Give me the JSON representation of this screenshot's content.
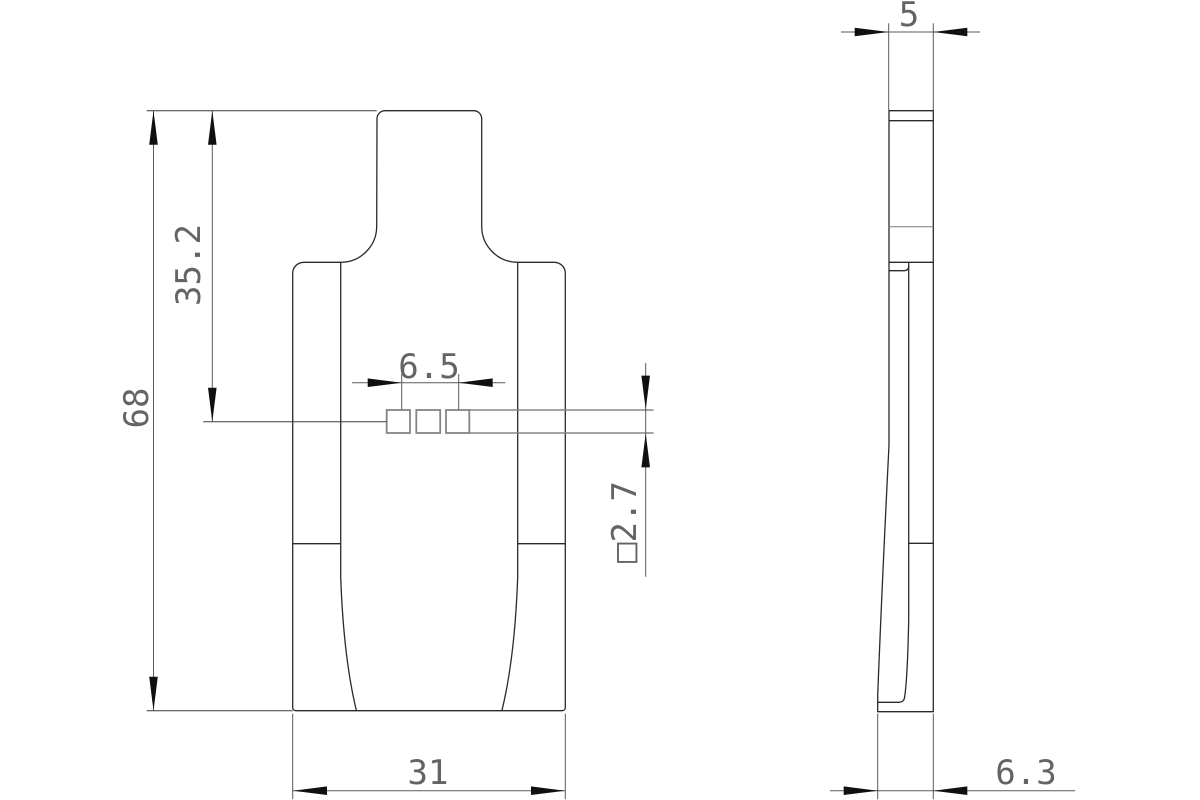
{
  "drawing": {
    "background_color": "#ffffff",
    "outline_color": "#2a2a2a",
    "dimension_line_color": "#5a5a5a",
    "dimension_text_color": "#646464",
    "arrow_color": "#101010",
    "front_view": {
      "dimensions": {
        "overall_height": "68",
        "upper_height": "35.2",
        "slot_span": "6.5",
        "slot_square": "□2.7",
        "overall_width": "31"
      }
    },
    "side_view": {
      "dimensions": {
        "thickness_top": "5",
        "thickness_bottom": "6.3"
      }
    }
  }
}
